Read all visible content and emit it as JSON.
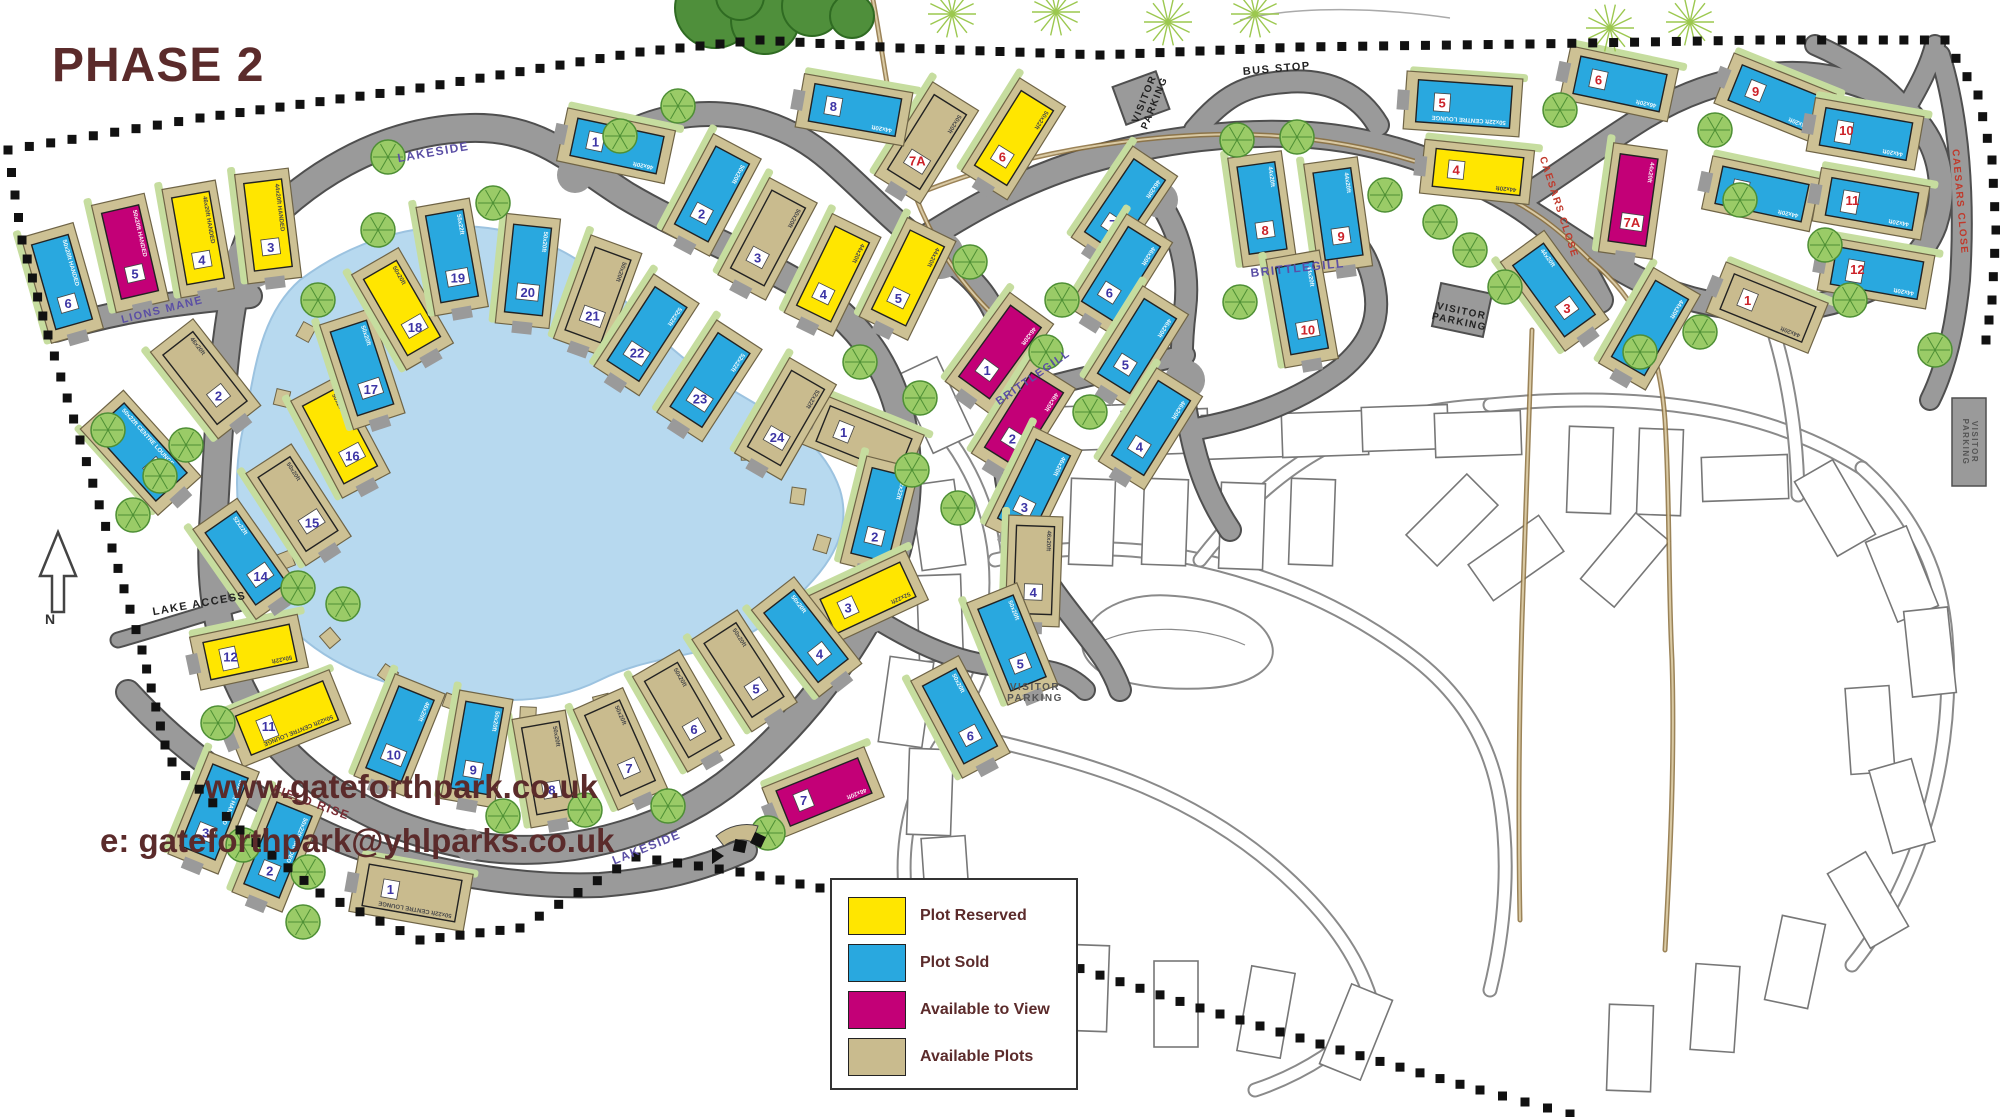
{
  "title": "PHASE 2",
  "footer": {
    "line1": "www.gateforthpark.co.uk",
    "line2": "e: gateforthpark@yhlparks.co.uk"
  },
  "compass": {
    "label": "N"
  },
  "legend": {
    "items": [
      {
        "status": "reserved",
        "label": "Plot Reserved"
      },
      {
        "status": "sold",
        "label": "Plot Sold"
      },
      {
        "status": "view",
        "label": "Available to View"
      },
      {
        "status": "available",
        "label": "Available Plots"
      }
    ]
  },
  "colors": {
    "reserved": "#FFE600",
    "sold": "#29A8DF",
    "view": "#C30077",
    "available": "#C9BB8E",
    "pad": "#CDC194",
    "road": "#9A9A9A",
    "road_edge": "#4F4F4F",
    "lake": "#B7D9EF",
    "num_purple": "#3D35A5",
    "num_red": "#CC2229",
    "brand_brown": "#5B2B2B",
    "label_purple": "#5B4FA5",
    "label_red": "#C0392B",
    "label_maroon": "#7A2E35",
    "ghost": "#8a8a8a"
  },
  "road_labels": [
    {
      "text": "LAKESIDE",
      "x": 434,
      "y": 156,
      "rot": -10,
      "color": "label_purple",
      "size": 12
    },
    {
      "text": "LAKESIDE",
      "x": 648,
      "y": 851,
      "rot": -22,
      "color": "label_purple",
      "size": 12
    },
    {
      "text": "LIONS MANE",
      "x": 163,
      "y": 313,
      "rot": -14,
      "color": "label_purple",
      "size": 11
    },
    {
      "text": "LAKE ACCESS",
      "x": 200,
      "y": 607,
      "rot": -10,
      "color": "#222222",
      "size": 11
    },
    {
      "text": "FIELD RISE",
      "x": 310,
      "y": 806,
      "rot": 20,
      "color": "label_maroon",
      "size": 12
    },
    {
      "text": "BRITTLEGILL",
      "x": 1298,
      "y": 272,
      "rot": -6,
      "color": "label_purple",
      "size": 12
    },
    {
      "text": "BRITTLEGILL",
      "x": 1035,
      "y": 380,
      "rot": -35,
      "color": "label_purple",
      "size": 11
    },
    {
      "text": "CAESARS CLOSE",
      "x": 1556,
      "y": 208,
      "rot": 72,
      "color": "label_red",
      "size": 10
    },
    {
      "text": "CAESARS CLOSE",
      "x": 1957,
      "y": 202,
      "rot": 85,
      "color": "label_red",
      "size": 10
    },
    {
      "text": "BUS STOP",
      "x": 1277,
      "y": 72,
      "rot": -5,
      "color": "#222222",
      "size": 11
    },
    {
      "text": "VISITOR PARKING",
      "lines": [
        "VISITOR",
        "PARKING"
      ],
      "x": 1147,
      "y": 100,
      "rot": -68,
      "color": "#222222",
      "size": 10
    },
    {
      "text": "VISITOR PARKING",
      "lines": [
        "VISITOR",
        "PARKING"
      ],
      "x": 1461,
      "y": 314,
      "rot": 12,
      "color": "#222222",
      "size": 10
    },
    {
      "text": "VISITOR PARKING",
      "lines": [
        "VISITOR",
        "PARKING"
      ],
      "x": 1035,
      "y": 690,
      "rot": 0,
      "color": "#555555",
      "size": 10
    },
    {
      "text": "VISITOR PARKING",
      "lines": [
        "VISITOR",
        "PARKING"
      ],
      "x": 1972,
      "y": 442,
      "rot": 90,
      "color": "#555555",
      "size": 8
    }
  ],
  "plots": [
    {
      "a": "lions-mane",
      "n": "1",
      "s": "sold",
      "x": 140,
      "y": 452,
      "r": -42,
      "size": "50x22ft CENTRE LOUNGE",
      "c": "purple"
    },
    {
      "a": "lions-mane",
      "n": "2",
      "s": "available",
      "x": 205,
      "y": 378,
      "r": -38,
      "size": "46x20ft",
      "c": "purple"
    },
    {
      "a": "lions-mane",
      "n": "3",
      "s": "reserved",
      "x": 268,
      "y": 225,
      "r": -7,
      "size": "44x20ft HANDED",
      "c": "purple"
    },
    {
      "a": "lions-mane",
      "n": "4",
      "s": "reserved",
      "x": 198,
      "y": 238,
      "r": -10,
      "size": "46x20ft HANDED",
      "c": "purple"
    },
    {
      "a": "lions-mane",
      "n": "5",
      "s": "view",
      "x": 130,
      "y": 252,
      "r": -13,
      "size": "50x20ft HANDED",
      "c": "purple"
    },
    {
      "a": "lions-mane",
      "n": "6",
      "s": "sold",
      "x": 62,
      "y": 282,
      "r": -16,
      "size": "50x20ft HANDED",
      "c": "purple"
    },
    {
      "a": "lakeside-ring",
      "n": "1",
      "s": "available",
      "x": 864,
      "y": 440,
      "r": 112,
      "size": "52x22ft",
      "c": "purple"
    },
    {
      "a": "lakeside-ring",
      "n": "2",
      "s": "sold",
      "x": 880,
      "y": 515,
      "r": 14,
      "size": "52x22ft",
      "c": "purple"
    },
    {
      "a": "lakeside-ring",
      "n": "3",
      "s": "reserved",
      "x": 868,
      "y": 598,
      "r": 65,
      "size": "52x22ft",
      "c": "purple"
    },
    {
      "a": "lakeside-ring",
      "n": "4",
      "s": "sold",
      "x": 806,
      "y": 636,
      "r": -38,
      "size": "50x20ft",
      "c": "purple"
    },
    {
      "a": "lakeside-ring",
      "n": "5",
      "s": "available",
      "x": 744,
      "y": 670,
      "r": -33,
      "size": "50x20ft",
      "c": "purple"
    },
    {
      "a": "lakeside-ring",
      "n": "6",
      "s": "available",
      "x": 683,
      "y": 710,
      "r": -30,
      "size": "50x20ft",
      "c": "purple"
    },
    {
      "a": "lakeside-ring",
      "n": "7",
      "s": "available",
      "x": 620,
      "y": 748,
      "r": -24,
      "size": "50x20ft",
      "c": "purple"
    },
    {
      "a": "lakeside-ring",
      "n": "8",
      "s": "available",
      "x": 548,
      "y": 768,
      "r": -10,
      "size": "50x20ft",
      "c": "purple"
    },
    {
      "a": "lakeside-ring",
      "n": "9",
      "s": "sold",
      "x": 477,
      "y": 748,
      "r": 10,
      "size": "50x20ft",
      "c": "purple"
    },
    {
      "a": "lakeside-ring",
      "n": "10",
      "s": "sold",
      "x": 400,
      "y": 734,
      "r": 22,
      "size": "46x20ft",
      "c": "purple"
    },
    {
      "a": "lakeside-ring",
      "n": "11",
      "s": "reserved",
      "x": 287,
      "y": 718,
      "r": 68,
      "size": "50x22ft CENTRE LOUNGE",
      "c": "purple"
    },
    {
      "a": "lakeside-ring",
      "n": "12",
      "s": "reserved",
      "x": 250,
      "y": 652,
      "r": 78,
      "size": "50x22ft",
      "c": "purple"
    },
    {
      "a": "lakeside-ring",
      "n": "14",
      "s": "sold",
      "x": 246,
      "y": 558,
      "r": -35,
      "size": "52x22ft",
      "c": "purple"
    },
    {
      "a": "lakeside-ring",
      "n": "15",
      "s": "available",
      "x": 298,
      "y": 504,
      "r": -33,
      "size": "50x20ft",
      "c": "purple"
    },
    {
      "a": "lakeside-ring",
      "n": "16",
      "s": "reserved",
      "x": 340,
      "y": 436,
      "r": -28,
      "size": "50x20ft",
      "c": "purple"
    },
    {
      "a": "lakeside-ring",
      "n": "17",
      "s": "sold",
      "x": 362,
      "y": 368,
      "r": -18,
      "size": "50x20ft",
      "c": "purple"
    },
    {
      "a": "lakeside-ring",
      "n": "18",
      "s": "reserved",
      "x": 402,
      "y": 308,
      "r": -30,
      "size": "50x20ft",
      "c": "purple"
    },
    {
      "a": "lakeside-ring",
      "n": "19",
      "s": "sold",
      "x": 452,
      "y": 256,
      "r": -10,
      "size": "55x22ft",
      "c": "purple"
    },
    {
      "a": "lakeside-ring",
      "n": "20",
      "s": "sold",
      "x": 528,
      "y": 270,
      "r": 6,
      "size": "50x20ft",
      "c": "purple"
    },
    {
      "a": "lakeside-ring",
      "n": "21",
      "s": "available",
      "x": 598,
      "y": 295,
      "r": 20,
      "size": "50x20ft",
      "c": "purple"
    },
    {
      "a": "lakeside-ring",
      "n": "22",
      "s": "sold",
      "x": 647,
      "y": 334,
      "r": 33,
      "size": "52x22ft",
      "c": "purple"
    },
    {
      "a": "lakeside-ring",
      "n": "23",
      "s": "sold",
      "x": 710,
      "y": 380,
      "r": 33,
      "size": "52x22ft",
      "c": "purple"
    },
    {
      "a": "lakeside-ring",
      "n": "24",
      "s": "available",
      "x": 786,
      "y": 418,
      "r": 30,
      "size": "52x22ft",
      "c": "purple"
    },
    {
      "a": "field-rise",
      "n": "1",
      "s": "available",
      "x": 412,
      "y": 893,
      "r": 100,
      "size": "50x22ft CENTRE LOUNGE",
      "c": "purple"
    },
    {
      "a": "field-rise",
      "n": "2",
      "s": "sold",
      "x": 278,
      "y": 850,
      "r": 22,
      "size": "50x22ft HANDED",
      "c": "purple"
    },
    {
      "a": "field-rise",
      "n": "3",
      "s": "sold",
      "x": 214,
      "y": 812,
      "r": 22,
      "size": "50x22ft HANDED",
      "c": "purple"
    },
    {
      "a": "lakeside-north",
      "n": "1",
      "s": "sold",
      "x": 617,
      "y": 146,
      "r": 102,
      "size": "46x20ft",
      "c": "purple"
    },
    {
      "a": "lakeside-north",
      "n": "2",
      "s": "sold",
      "x": 712,
      "y": 194,
      "r": 28,
      "size": "50x20ft",
      "c": "purple"
    },
    {
      "a": "lakeside-north",
      "n": "3",
      "s": "available",
      "x": 768,
      "y": 238,
      "r": 28,
      "size": "50x20ft",
      "c": "purple"
    },
    {
      "a": "lakeside-north",
      "n": "4",
      "s": "reserved",
      "x": 833,
      "y": 274,
      "r": 26,
      "size": "44x20ft",
      "c": "purple"
    },
    {
      "a": "lakeside-north",
      "n": "5",
      "s": "reserved",
      "x": 908,
      "y": 278,
      "r": 26,
      "size": "44x20ft",
      "c": "purple"
    },
    {
      "a": "lakeside-north",
      "n": "6",
      "s": "reserved",
      "x": 1014,
      "y": 138,
      "r": 32,
      "size": "50x22ft",
      "c": "red"
    },
    {
      "a": "lakeside-north",
      "n": "7A",
      "s": "available",
      "x": 927,
      "y": 142,
      "r": 32,
      "size": "50x20ft",
      "c": "red"
    },
    {
      "a": "lakeside-north",
      "n": "8",
      "s": "sold",
      "x": 855,
      "y": 110,
      "r": 100,
      "size": "44x20ft",
      "c": "purple"
    },
    {
      "a": "brittlegill",
      "n": "1",
      "s": "view",
      "x": 1000,
      "y": 352,
      "r": 36,
      "size": "46x20ft",
      "c": "purple"
    },
    {
      "a": "brittlegill",
      "n": "2",
      "s": "view",
      "x": 1024,
      "y": 420,
      "r": 32,
      "size": "46x20ft",
      "c": "purple"
    },
    {
      "a": "brittlegill",
      "n": "3",
      "s": "sold",
      "x": 1034,
      "y": 487,
      "r": 26,
      "size": "46x20ft",
      "c": "purple"
    },
    {
      "a": "brittlegill",
      "n": "4",
      "s": "available",
      "x": 1034,
      "y": 570,
      "r": 2,
      "size": "46x20ft",
      "c": "purple"
    },
    {
      "a": "brittlegill",
      "n": "5",
      "s": "sold",
      "x": 1012,
      "y": 643,
      "r": -22,
      "size": "50x20ft",
      "c": "purple"
    },
    {
      "a": "brittlegill",
      "n": "6",
      "s": "sold",
      "x": 960,
      "y": 716,
      "r": -28,
      "size": "50x20ft",
      "c": "purple"
    },
    {
      "a": "brittlegill",
      "n": "7",
      "s": "view",
      "x": 824,
      "y": 792,
      "r": 68,
      "size": "46x20ft",
      "c": "purple"
    },
    {
      "a": "brittlegill-east",
      "n": "7",
      "s": "sold",
      "x": 1125,
      "y": 206,
      "r": 34,
      "size": "46x20ft",
      "c": "purple"
    },
    {
      "a": "brittlegill-east",
      "n": "6",
      "s": "sold",
      "x": 1121,
      "y": 274,
      "r": 32,
      "size": "46x20ft",
      "c": "purple"
    },
    {
      "a": "brittlegill-east",
      "n": "5",
      "s": "sold",
      "x": 1137,
      "y": 346,
      "r": 32,
      "size": "46x20ft",
      "c": "purple"
    },
    {
      "a": "brittlegill-east",
      "n": "4",
      "s": "sold",
      "x": 1151,
      "y": 428,
      "r": 32,
      "size": "46x20ft",
      "c": "purple"
    },
    {
      "a": "brittlegill-east",
      "n": "8",
      "s": "sold",
      "x": 1262,
      "y": 208,
      "r": -8,
      "size": "44x20ft",
      "c": "red"
    },
    {
      "a": "brittlegill-east",
      "n": "9",
      "s": "sold",
      "x": 1338,
      "y": 214,
      "r": -8,
      "size": "44x20ft",
      "c": "red"
    },
    {
      "a": "brittlegill-east",
      "n": "10",
      "s": "sold",
      "x": 1302,
      "y": 308,
      "r": -10,
      "size": "44x20ft",
      "c": "red"
    },
    {
      "a": "caesars-close",
      "n": "1",
      "s": "available",
      "x": 1768,
      "y": 308,
      "r": 112,
      "size": "44x20ft",
      "c": "red"
    },
    {
      "a": "caesars-close",
      "n": "2",
      "s": "sold",
      "x": 1650,
      "y": 328,
      "r": 30,
      "size": "44x20ft",
      "c": "red"
    },
    {
      "a": "caesars-close",
      "n": "3",
      "s": "sold",
      "x": 1554,
      "y": 290,
      "r": -36,
      "size": "44x20ft",
      "c": "red"
    },
    {
      "a": "caesars-close",
      "n": "4",
      "s": "reserved",
      "x": 1478,
      "y": 172,
      "r": 96,
      "size": "44x20ft",
      "c": "red"
    },
    {
      "a": "caesars-close",
      "n": "5",
      "s": "sold",
      "x": 1464,
      "y": 104,
      "r": 94,
      "size": "50x22ft CENTRE LOUNGE",
      "c": "red"
    },
    {
      "a": "caesars-close",
      "n": "6",
      "s": "sold",
      "x": 1620,
      "y": 84,
      "r": 102,
      "size": "46x20ft",
      "c": "red"
    },
    {
      "a": "caesars-close",
      "n": "7A",
      "s": "view",
      "x": 1633,
      "y": 200,
      "r": 8,
      "size": "44x20ft",
      "c": "red"
    },
    {
      "a": "caesars-close",
      "n": "8",
      "s": "sold",
      "x": 1762,
      "y": 194,
      "r": 102,
      "size": "44x20ft",
      "c": "red"
    },
    {
      "a": "caesars-close",
      "n": "9",
      "s": "sold",
      "x": 1776,
      "y": 99,
      "r": 112,
      "size": "44x20ft",
      "c": "red"
    },
    {
      "a": "caesars-close",
      "n": "10",
      "s": "sold",
      "x": 1866,
      "y": 134,
      "r": 100,
      "size": "44x20ft",
      "c": "red"
    },
    {
      "a": "caesars-close",
      "n": "11",
      "s": "sold",
      "x": 1872,
      "y": 204,
      "r": 100,
      "size": "44x20ft",
      "c": "red"
    },
    {
      "a": "caesars-close",
      "n": "12",
      "s": "sold",
      "x": 1877,
      "y": 273,
      "r": 100,
      "size": "44x20ft",
      "c": "red"
    }
  ],
  "trees": [
    [
      493,
      203
    ],
    [
      378,
      230
    ],
    [
      318,
      300
    ],
    [
      620,
      136
    ],
    [
      678,
      106
    ],
    [
      388,
      157
    ],
    [
      160,
      476
    ],
    [
      133,
      515
    ],
    [
      186,
      445
    ],
    [
      108,
      430
    ],
    [
      298,
      588
    ],
    [
      343,
      604
    ],
    [
      218,
      723
    ],
    [
      243,
      845
    ],
    [
      308,
      872
    ],
    [
      303,
      922
    ],
    [
      503,
      816
    ],
    [
      585,
      810
    ],
    [
      668,
      806
    ],
    [
      768,
      833
    ],
    [
      860,
      362
    ],
    [
      920,
      398
    ],
    [
      1062,
      300
    ],
    [
      1046,
      352
    ],
    [
      1090,
      412
    ],
    [
      970,
      262
    ],
    [
      912,
      470
    ],
    [
      958,
      508
    ],
    [
      1237,
      140
    ],
    [
      1297,
      137
    ],
    [
      1385,
      195
    ],
    [
      1440,
      222
    ],
    [
      1470,
      250
    ],
    [
      1505,
      287
    ],
    [
      1240,
      302
    ],
    [
      1560,
      110
    ],
    [
      1715,
      130
    ],
    [
      1740,
      200
    ],
    [
      1825,
      245
    ],
    [
      1850,
      300
    ],
    [
      1700,
      332
    ],
    [
      1640,
      352
    ],
    [
      1935,
      350
    ]
  ],
  "starburst_trees": [
    [
      952,
      14
    ],
    [
      1056,
      12
    ],
    [
      1168,
      22
    ],
    [
      1255,
      14
    ],
    [
      1610,
      28
    ],
    [
      1690,
      22
    ]
  ],
  "jetties": [
    [
      536,
      248
    ],
    [
      588,
      296
    ],
    [
      638,
      348
    ],
    [
      692,
      408
    ],
    [
      748,
      452
    ],
    [
      798,
      496
    ],
    [
      822,
      544
    ],
    [
      794,
      598
    ],
    [
      738,
      648
    ],
    [
      672,
      680
    ],
    [
      602,
      702
    ],
    [
      528,
      714
    ],
    [
      452,
      702
    ],
    [
      388,
      674
    ],
    [
      330,
      638
    ],
    [
      286,
      560
    ],
    [
      270,
      478
    ],
    [
      282,
      398
    ],
    [
      306,
      332
    ]
  ],
  "future_phase": {
    "plots": [
      [
        935,
        405,
        -25
      ],
      [
        1005,
        392,
        -18
      ],
      [
        1085,
        428,
        88
      ],
      [
        1165,
        432,
        88
      ],
      [
        1245,
        436,
        88
      ],
      [
        1325,
        434,
        88
      ],
      [
        1405,
        428,
        88
      ],
      [
        1478,
        434,
        88
      ],
      [
        938,
        525,
        -8
      ],
      [
        1092,
        522,
        2
      ],
      [
        1165,
        522,
        2
      ],
      [
        1242,
        526,
        2
      ],
      [
        1312,
        522,
        2
      ],
      [
        1452,
        520,
        45
      ],
      [
        1516,
        558,
        55
      ],
      [
        940,
        618,
        -2
      ],
      [
        906,
        702,
        8
      ],
      [
        930,
        792,
        2
      ],
      [
        946,
        880,
        -4
      ],
      [
        996,
        954,
        12
      ],
      [
        1086,
        988,
        2
      ],
      [
        1176,
        1004,
        0
      ],
      [
        1266,
        1012,
        10
      ],
      [
        1356,
        1032,
        22
      ],
      [
        1590,
        470,
        2
      ],
      [
        1660,
        472,
        2
      ],
      [
        1745,
        478,
        88
      ],
      [
        1835,
        508,
        -30
      ],
      [
        1902,
        574,
        -22
      ],
      [
        1930,
        652,
        -6
      ],
      [
        1625,
        560,
        40
      ],
      [
        1870,
        730,
        -4
      ],
      [
        1902,
        806,
        -16
      ],
      [
        1868,
        900,
        -30
      ],
      [
        1795,
        962,
        12
      ],
      [
        1715,
        1008,
        4
      ],
      [
        1630,
        1048,
        2
      ]
    ]
  }
}
